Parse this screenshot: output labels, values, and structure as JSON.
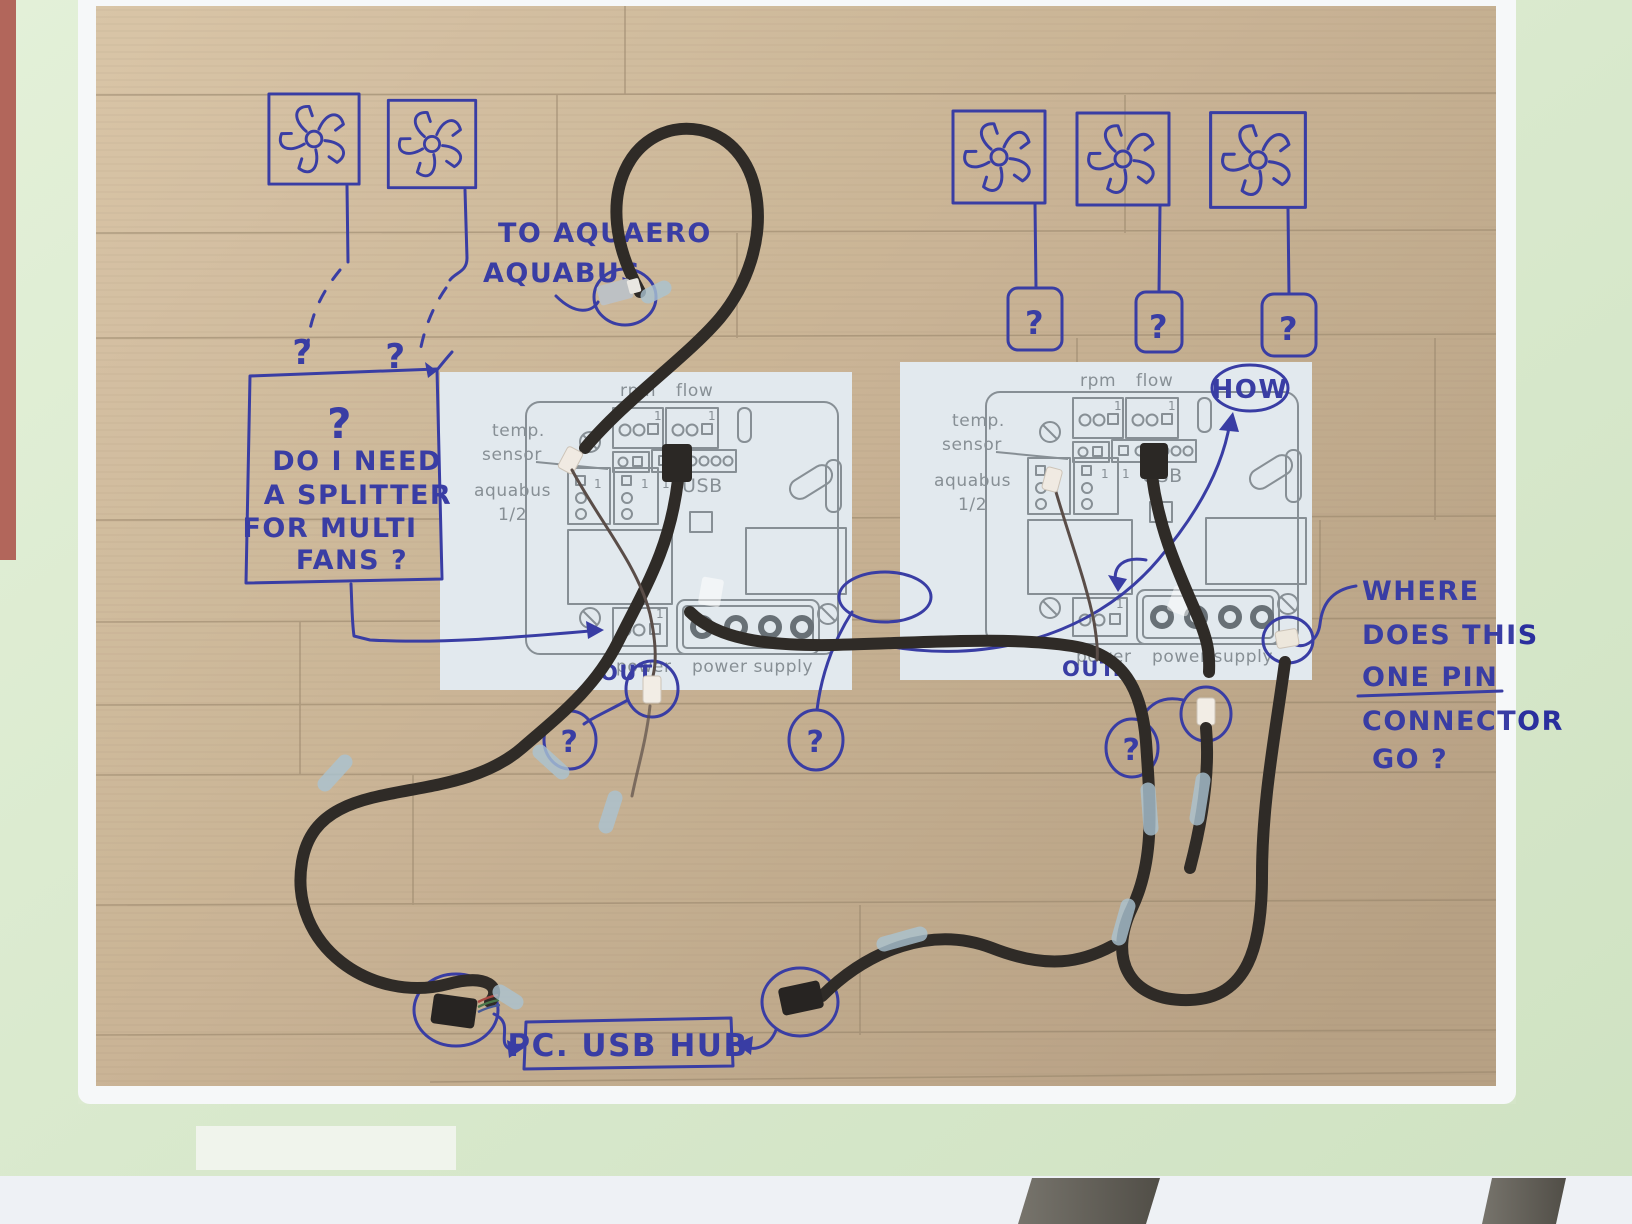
{
  "photo": {
    "annotations": {
      "q": "?",
      "to_aquaero": [
        "TO AQUAERO",
        "AQUABUS"
      ],
      "splitter_question": "?",
      "splitter": [
        "DO I NEED",
        "A SPLITTER",
        "FOR MULTI",
        "FANS ?"
      ],
      "how": "HOW",
      "where": [
        "WHERE",
        "DOES THIS",
        "ONE PIN",
        "CONNECTOR",
        "GO ?"
      ],
      "usb_hub": "PC. USB HUB",
      "out_handwritten": "OUT."
    },
    "board_print": {
      "rpm": "rpm",
      "flow": "flow",
      "temp_line1": "temp.",
      "temp_line2": "sensor",
      "aquabus_line1": "aquabus",
      "aquabus_line2": "1/2",
      "usb": "USB",
      "power": "power",
      "power_supply": "power supply",
      "pin1": "1"
    },
    "colors": {
      "ink": "#2a2f9e",
      "pcb_print": "#7e878d",
      "sheet": "#e0e8ed",
      "wood": "#c7b08f",
      "table": "#dcead0",
      "cable": "#201b17",
      "tape": "#a4bfce"
    }
  }
}
